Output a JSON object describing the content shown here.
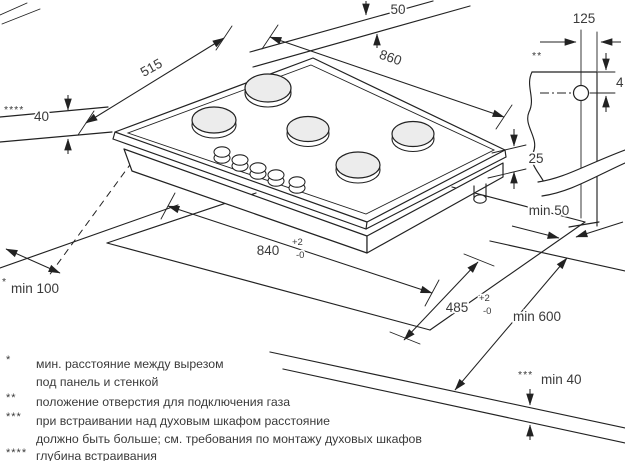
{
  "diagram": {
    "dimensions": {
      "rear_wall_clearance": {
        "value": "50"
      },
      "hob_depth": {
        "value": "515"
      },
      "hob_width": {
        "value": "860"
      },
      "gas_hole_offset": {
        "value": "125",
        "marker": "**"
      },
      "gas_hole_down": {
        "value": "4"
      },
      "body_height": {
        "value": "25"
      },
      "side_clearance": {
        "value": "min 50"
      },
      "cutout_width": {
        "value": "840",
        "tol_plus": "+2",
        "tol_minus": "-0"
      },
      "cutout_depth": {
        "value": "485",
        "tol_plus": "+2",
        "tol_minus": "-0"
      },
      "worktop_depth": {
        "value": "min 600"
      },
      "left_clearance": {
        "value": "min 100",
        "marker": "*"
      },
      "under_clearance": {
        "value": "min 40",
        "marker": "***"
      },
      "embed_depth": {
        "value": "40",
        "marker": "****"
      }
    },
    "footnotes": [
      {
        "marker": "*",
        "lines": [
          "мин. расстояние между вырезом",
          "под панель и стенкой"
        ]
      },
      {
        "marker": "**",
        "lines": [
          "положение отверстия для подключения газа"
        ]
      },
      {
        "marker": "***",
        "lines": [
          "при встраивании над духовым шкафом расстояние",
          "должно быть больше; см. требования по монтажу духовых шкафов"
        ]
      },
      {
        "marker": "****",
        "lines": [
          "глубина встраивания"
        ]
      }
    ]
  }
}
